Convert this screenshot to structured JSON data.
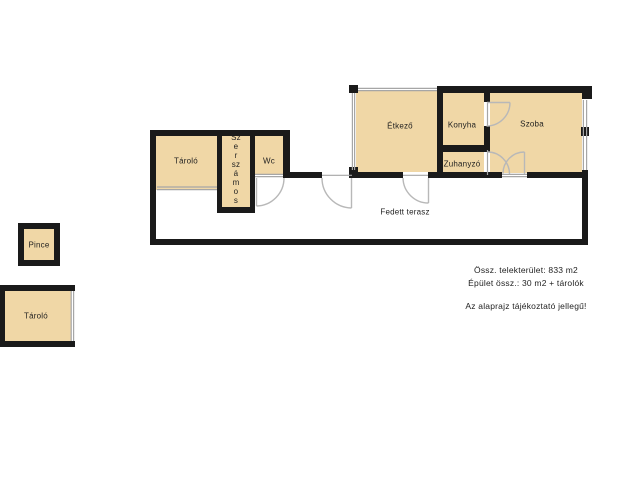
{
  "floorplan": {
    "rooms": {
      "tarolo_upper": "Tároló",
      "szerszamos_vertical": "Sz\ne\nr\nsz\ná\nm\no\ns",
      "wc": "Wc",
      "etkezo": "Étkező",
      "konyha": "Konyha",
      "szoba": "Szoba",
      "zuhanyzo": "Zuhanyzó",
      "fedett_terasz": "Fedett terasz",
      "pince": "Pince",
      "tarolo_lower": "Tároló"
    },
    "notes": {
      "plot_area": "Össz. telekterület: 833 m2",
      "building_area": "Épület össz.: 30 m2 + tárolók",
      "disclaimer": "Az alaprajz tájékoztató jellegű!"
    },
    "colors": {
      "wall": "#1a1a1a",
      "room_fill": "#f0d7a6",
      "door_line": "#b8b8b8",
      "window_line": "#a6a6a6",
      "text": "#1f1f1f",
      "background": "#ffffff"
    }
  }
}
